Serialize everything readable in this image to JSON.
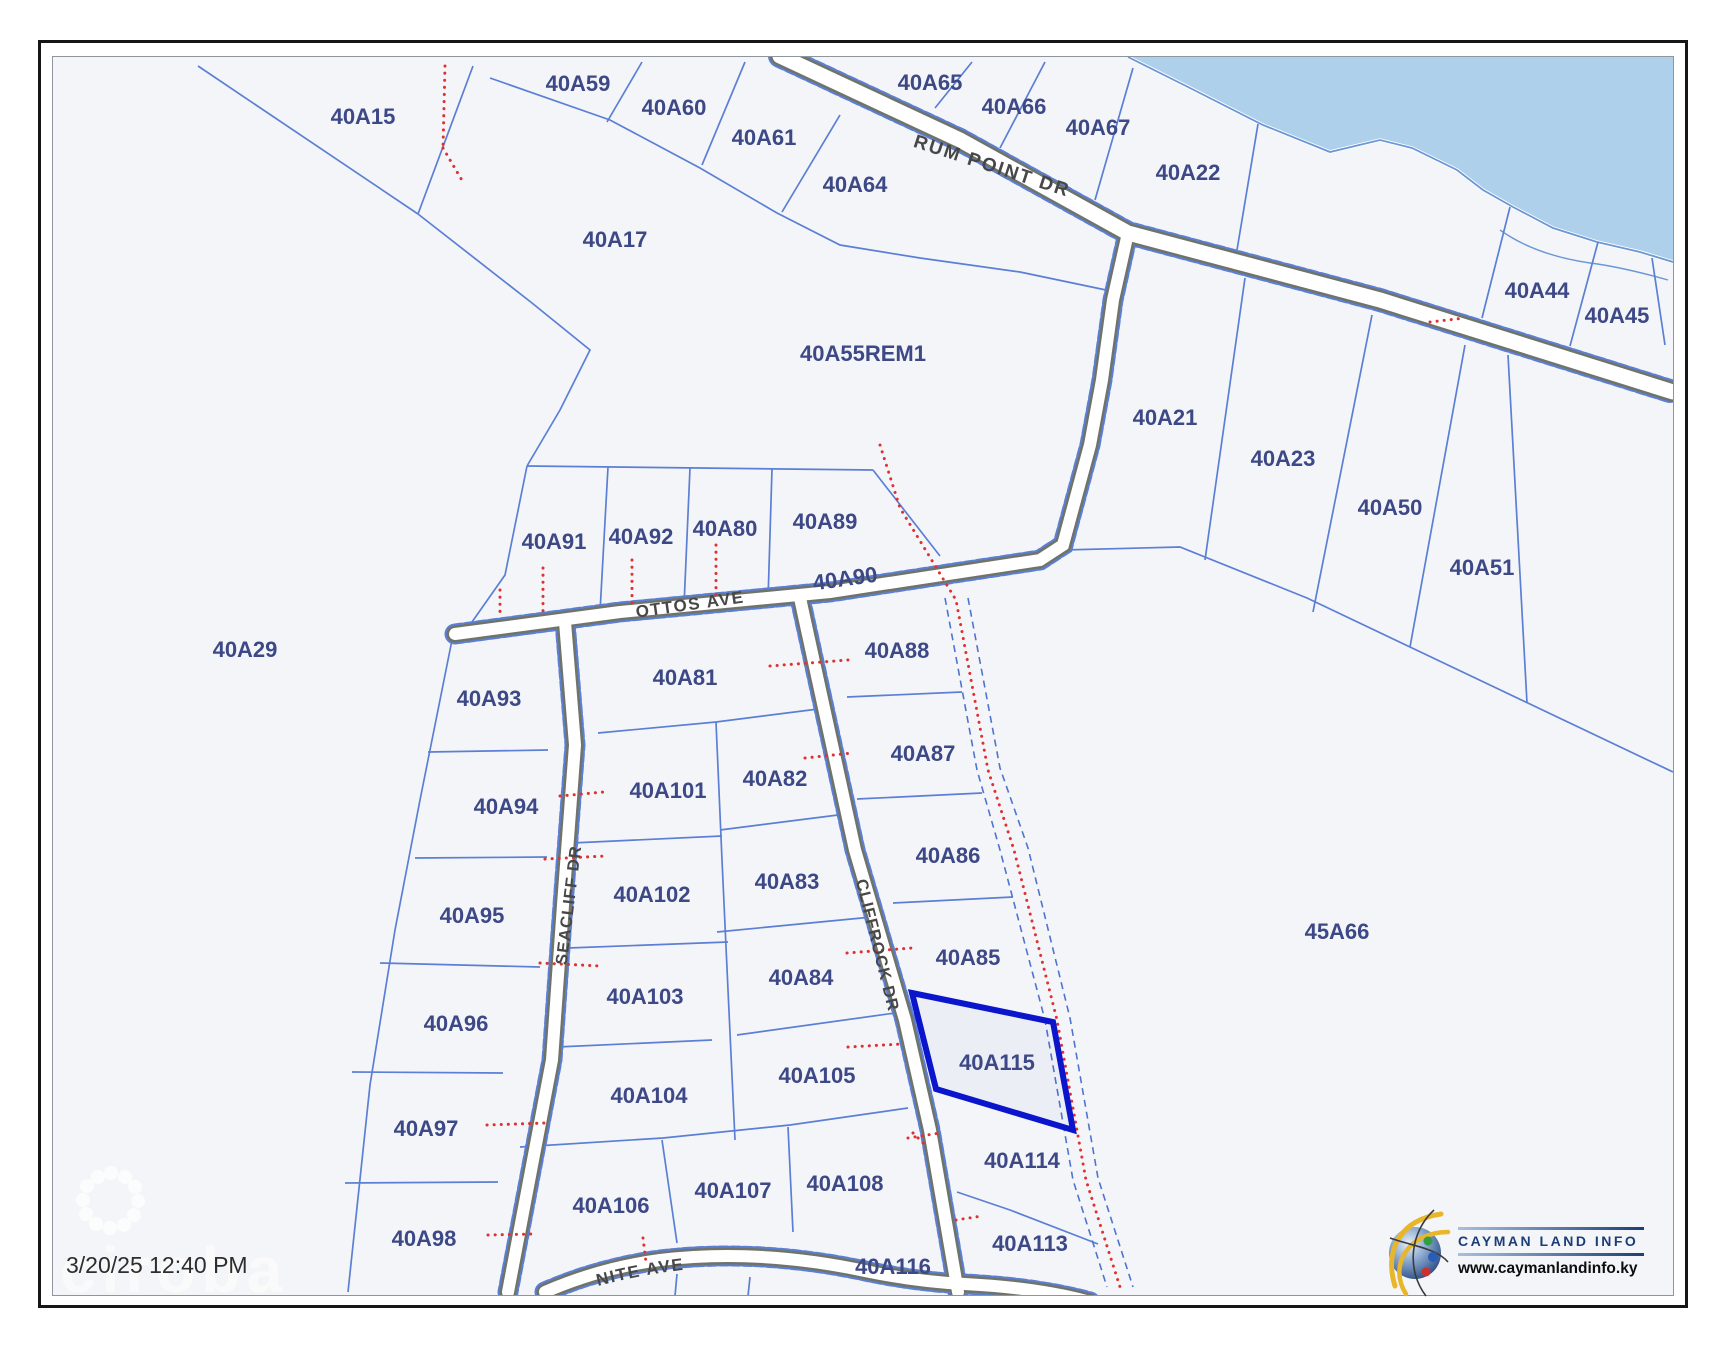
{
  "map": {
    "timestamp": "3/20/25 12:40 PM",
    "watermark": "ciroba",
    "selected_parcel": "40A115",
    "roads": {
      "rum_point": "RUM POINT DR",
      "ottos": "OTTOS AVE",
      "seacliff": "SEACLIFF DR",
      "cliffrock": "CLIFFROCK DR",
      "caymanite": "CAYMANITE AVE"
    },
    "parcels": {
      "p15": "40A15",
      "p17": "40A17",
      "p29": "40A29",
      "p55rem1": "40A55REM1",
      "p59": "40A59",
      "p60": "40A60",
      "p61": "40A61",
      "p64": "40A64",
      "p65": "40A65",
      "p66": "40A66",
      "p67": "40A67",
      "p22": "40A22",
      "p44": "40A44",
      "p45": "40A45",
      "p21": "40A21",
      "p23": "40A23",
      "p50": "40A50",
      "p51": "40A51",
      "p45a66": "45A66",
      "p91": "40A91",
      "p92": "40A92",
      "p80": "40A80",
      "p89": "40A89",
      "p90": "40A90",
      "p93": "40A93",
      "p94": "40A94",
      "p95": "40A95",
      "p96": "40A96",
      "p97": "40A97",
      "p98": "40A98",
      "p81": "40A81",
      "p88": "40A88",
      "p87": "40A87",
      "p86": "40A86",
      "p85": "40A85",
      "p101": "40A101",
      "p102": "40A102",
      "p103": "40A103",
      "p104": "40A104",
      "p82": "40A82",
      "p83": "40A83",
      "p84": "40A84",
      "p105": "40A105",
      "p106": "40A106",
      "p107": "40A107",
      "p108": "40A108",
      "p115": "40A115",
      "p114": "40A114",
      "p113": "40A113",
      "p116": "40A116"
    },
    "colors": {
      "parcel_line": "#5b7fd4",
      "parcel_label": "#3d4886",
      "highlight": "#0b16cc",
      "water": "#aed0ea",
      "red_dotted": "#e03131",
      "road_label": "#474747",
      "background": "#f4f5f8"
    }
  },
  "logo": {
    "title": "CAYMAN LAND INFO",
    "url": "www.caymanlandinfo.ky"
  }
}
